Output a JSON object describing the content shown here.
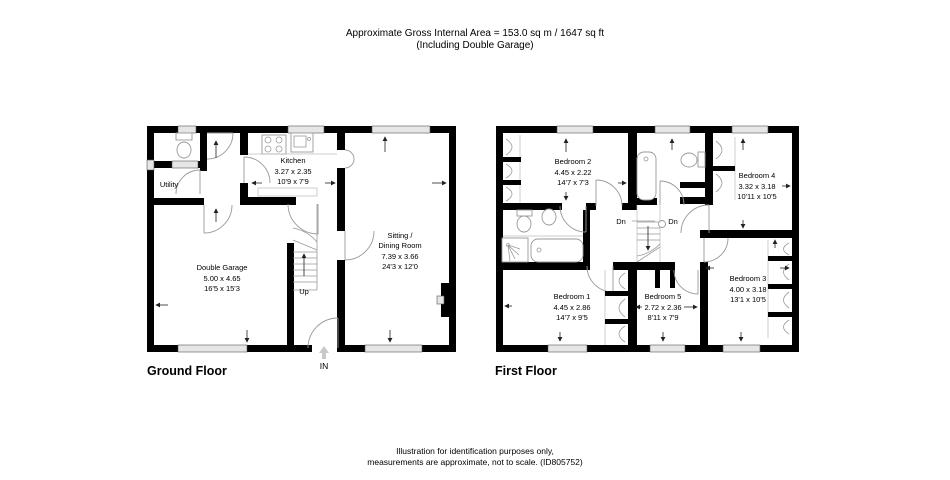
{
  "header": {
    "line1": "Approximate Gross Internal Area = 153.0 sq m / 1647 sq ft",
    "line2": "(Including Double Garage)"
  },
  "footer": {
    "line1": "Illustration for identification purposes only,",
    "line2": "measurements are approximate, not to scale. (ID805752)"
  },
  "ground_floor": {
    "title": "Ground Floor",
    "stairs_label": "Up",
    "entrance_label": "IN",
    "rooms": {
      "utility": {
        "name": "Utility"
      },
      "kitchen": {
        "name": "Kitchen",
        "metric": "3.27 x 2.35",
        "imperial": "10'9 x 7'9"
      },
      "garage": {
        "name": "Double Garage",
        "metric": "5.00 x 4.65",
        "imperial": "16'5 x 15'3"
      },
      "sitting": {
        "name_line1": "Sitting /",
        "name_line2": "Dining Room",
        "metric": "7.39 x 3.66",
        "imperial": "24'3 x 12'0"
      }
    }
  },
  "first_floor": {
    "title": "First Floor",
    "stairs_label_left": "Dn",
    "stairs_label_right": "Dn",
    "rooms": {
      "bedroom1": {
        "name": "Bedroom 1",
        "metric": "4.45 x 2.86",
        "imperial": "14'7 x 9'5"
      },
      "bedroom2": {
        "name": "Bedroom 2",
        "metric": "4.45 x 2.22",
        "imperial": "14'7 x 7'3"
      },
      "bedroom3": {
        "name": "Bedroom 3",
        "metric": "4.00 x 3.18",
        "imperial": "13'1 x 10'5"
      },
      "bedroom4": {
        "name": "Bedroom 4",
        "metric": "3.32 x 3.18",
        "imperial": "10'11 x 10'5"
      },
      "bedroom5": {
        "name": "Bedroom 5",
        "metric": "2.72 x 2.36",
        "imperial": "8'11 x 7'9"
      }
    }
  },
  "colors": {
    "background": "#ffffff",
    "walls": "#000000",
    "windows": "#e6e6e6",
    "fixtures": "#999999",
    "text": "#000000"
  }
}
